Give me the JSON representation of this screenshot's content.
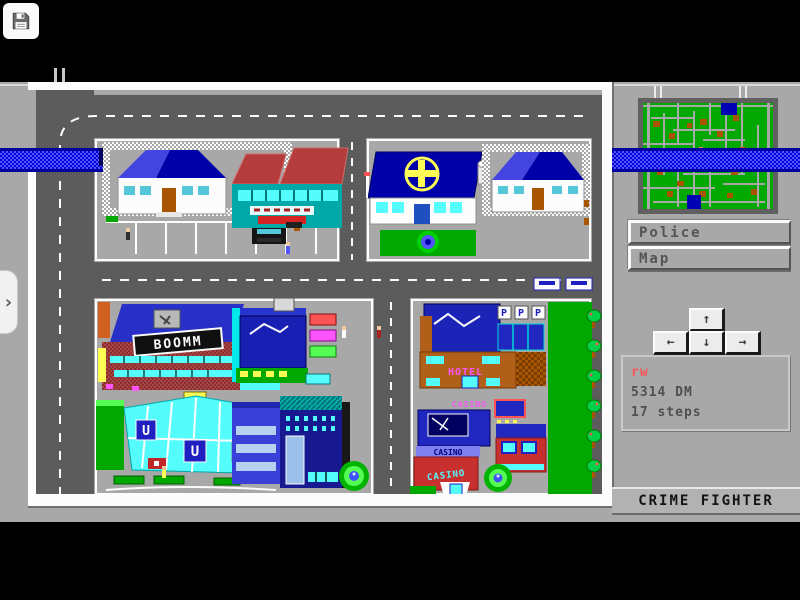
{
  "window": {
    "save_icon": "floppy-disk"
  },
  "overlay": {
    "expand_chevron": "›"
  },
  "panel": {
    "buttons": {
      "police": "Police",
      "map": "Map"
    },
    "dpad": {
      "up": "↑",
      "left": "←",
      "down": "↓",
      "right": "→"
    },
    "status": {
      "player": "rw",
      "money": "5314 DM",
      "steps": "17 steps"
    },
    "banner": "CRIME FIGHTER"
  },
  "city": {
    "signs": {
      "boomm": "BOOMM",
      "hotel": "HOTEL",
      "casino": "CASINO",
      "subway_u": "U",
      "parking_p": "P"
    }
  },
  "colors": {
    "background_gray": "#a8a8a8",
    "road_gray": "#5c5c5c",
    "river_blue": "#3434fc",
    "roof_blue": "#0000a8",
    "park_green": "#00a800",
    "status_red": "#fc5454"
  }
}
